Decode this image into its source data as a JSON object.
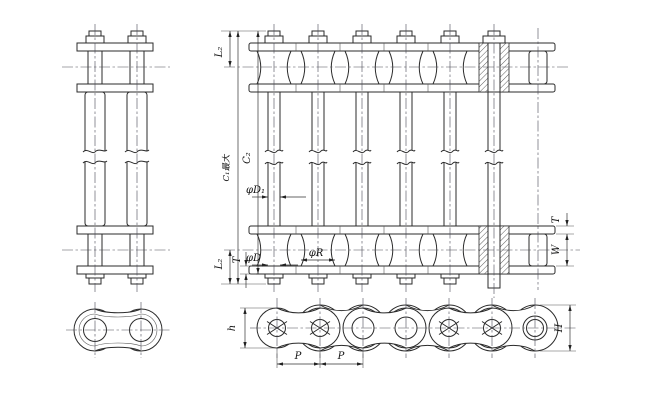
{
  "drawing": {
    "type": "roller-chain-dimensional-drawing",
    "colors": {
      "line": "#2b2b2b",
      "background": "#ffffff",
      "dimension": "#333333"
    }
  },
  "views": {
    "plan": {
      "labels": {
        "l2_top": "L₂",
        "c1_max": "C₁最大",
        "c2": "C₂",
        "phi_d1": "φD₁",
        "l2_bottom": "L₂",
        "t_left": "T",
        "phi_d": "φD",
        "phi_r": "φR",
        "t_right": "T",
        "w": "W"
      }
    },
    "side": {
      "labels": {
        "h": "h",
        "cap_h": "H",
        "p1": "P",
        "p2": "P"
      }
    }
  }
}
